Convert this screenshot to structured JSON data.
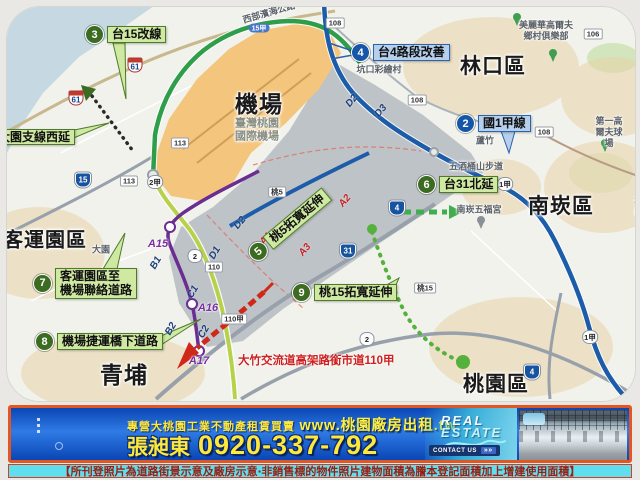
{
  "colors": {
    "green_label_bg": "#cfe8a2",
    "green_circle": "#3c6b22",
    "blue_label_bg": "#b5cfec",
    "blue_circle": "#1556a8",
    "expressway_green": "#2e9e4a",
    "highway_blue": "#1c5ca8",
    "mrt_purple": "#6a2d91",
    "banner_blue": "#1050c8",
    "banner_border": "#e35622",
    "banner_yellow": "#ffe83a",
    "disclaimer_bg": "#5fdeee",
    "disclaimer_text": "#9b1c10",
    "airport_orange": "#f4c57c",
    "note_red": "#cf1f1f"
  },
  "map": {
    "region_labels": [
      {
        "id": "airport",
        "text": "機場",
        "x": 258,
        "y": 103,
        "size": 23
      },
      {
        "id": "airport-subtitle",
        "text": "臺灣桃園\n國際機場",
        "x": 256,
        "y": 129,
        "size": 11,
        "muted": true
      },
      {
        "id": "linkou-district",
        "text": "林口區",
        "x": 492,
        "y": 66,
        "size": 21
      },
      {
        "id": "nankan-district",
        "text": "南崁區",
        "x": 560,
        "y": 206,
        "size": 21
      },
      {
        "id": "taoyuan-district",
        "text": "桃園區",
        "x": 495,
        "y": 384,
        "size": 21
      },
      {
        "id": "qingpu",
        "text": "青埔",
        "x": 123,
        "y": 374,
        "size": 23
      },
      {
        "id": "bus-terminal-park",
        "text": "客運園區",
        "x": 44,
        "y": 240,
        "size": 20
      }
    ],
    "place_labels": [
      {
        "id": "west-coast-highway",
        "text": "西部濱海公路",
        "x": 268,
        "y": 12,
        "rot": -16
      },
      {
        "id": "kengkou-painted-village",
        "text": "坑口彩繪村",
        "x": 378,
        "y": 69
      },
      {
        "id": "miramar-golf-club",
        "text": "美麗華高爾夫\n鄉村俱樂部",
        "x": 545,
        "y": 30
      },
      {
        "id": "first-golf-course",
        "text": "第一高爾夫球場",
        "x": 608,
        "y": 131
      },
      {
        "id": "wujiutong-trail",
        "text": "五酒桶山步道",
        "x": 475,
        "y": 166
      },
      {
        "id": "nankan-wufu-temple",
        "text": "南崁五福宮",
        "x": 478,
        "y": 209
      },
      {
        "id": "luzhu",
        "text": "蘆竹",
        "x": 484,
        "y": 140
      },
      {
        "id": "dayuan",
        "text": "大園",
        "x": 100,
        "y": 249
      },
      {
        "id": "taoyuan-edge",
        "text": "桃園",
        "x": 638,
        "y": 206
      }
    ],
    "project_labels": [
      {
        "id": "p3-tai15-reroute",
        "num": "3",
        "text": "台15改線",
        "color": "green",
        "x": 84,
        "y": 24
      },
      {
        "id": "p4-tai4-improvement",
        "num": "4",
        "text": "台4路段改善",
        "color": "blue",
        "x": 350,
        "y": 42
      },
      {
        "id": "p2-national1a",
        "num": "2",
        "text": "國1甲線",
        "color": "blue",
        "x": 455,
        "y": 113
      },
      {
        "id": "p6-tai31-north-ext",
        "num": "6",
        "text": "台31北延",
        "color": "green",
        "x": 416,
        "y": 174
      },
      {
        "id": "p5-tao5-widening",
        "num": "5",
        "text": "桃5拓寬延伸",
        "color": "green",
        "x": 250,
        "y": 247,
        "rot": -40
      },
      {
        "id": "p7-terminal-airport-link",
        "num": "7",
        "text": "客運園區至\n機場聯絡道路",
        "color": "green",
        "x": 32,
        "y": 267
      },
      {
        "id": "p8-mrt-underbridge-road",
        "num": "8",
        "text": "機場捷運橋下道路",
        "color": "green",
        "x": 34,
        "y": 331
      },
      {
        "id": "p9-tao15-widening",
        "num": "9",
        "text": "桃15拓寬延伸",
        "color": "green",
        "x": 291,
        "y": 282
      },
      {
        "id": "p1-dayuan-branch-west-ext",
        "num": "",
        "text": "大園支線西延",
        "color": "green",
        "x": -8,
        "y": 128
      }
    ],
    "red_note": {
      "id": "dazhu-interchange-note",
      "text": "大竹交流道高架路銜市道110甲",
      "x": 237,
      "y": 351
    },
    "shields": [
      {
        "kind": "expwy",
        "text": "61",
        "x": 75,
        "y": 97
      },
      {
        "kind": "expwy",
        "text": "61",
        "x": 134,
        "y": 64
      },
      {
        "kind": "pill",
        "text": "15甲",
        "x": 258,
        "y": 27
      },
      {
        "kind": "prov",
        "text": "15",
        "x": 82,
        "y": 179
      },
      {
        "kind": "prov",
        "text": "31",
        "x": 347,
        "y": 250
      },
      {
        "kind": "prov",
        "text": "4",
        "x": 396,
        "y": 207
      },
      {
        "kind": "prov",
        "text": "4",
        "x": 531,
        "y": 371
      },
      {
        "kind": "flower",
        "text": "2甲",
        "x": 154,
        "y": 181
      },
      {
        "kind": "flower",
        "text": "1甲",
        "x": 504,
        "y": 183
      },
      {
        "kind": "flower",
        "text": "1甲",
        "x": 589,
        "y": 336
      },
      {
        "kind": "flower",
        "text": "2",
        "x": 194,
        "y": 255
      },
      {
        "kind": "flower",
        "text": "2",
        "x": 366,
        "y": 338
      },
      {
        "kind": "rect",
        "text": "113",
        "x": 128,
        "y": 180
      },
      {
        "kind": "rect",
        "text": "113",
        "x": 179,
        "y": 142
      },
      {
        "kind": "rect",
        "text": "110",
        "x": 213,
        "y": 266
      },
      {
        "kind": "rect",
        "text": "110甲",
        "x": 233,
        "y": 318
      },
      {
        "kind": "rect",
        "text": "桃5",
        "x": 276,
        "y": 191
      },
      {
        "kind": "rect",
        "text": "桃15",
        "x": 424,
        "y": 287
      },
      {
        "kind": "rect",
        "text": "108",
        "x": 334,
        "y": 22
      },
      {
        "kind": "rect",
        "text": "108",
        "x": 416,
        "y": 99
      },
      {
        "kind": "rect",
        "text": "108",
        "x": 543,
        "y": 131
      },
      {
        "kind": "rect",
        "text": "106",
        "x": 592,
        "y": 33
      }
    ],
    "stations": [
      {
        "id": "station-a15",
        "text": "A15",
        "x": 157,
        "y": 243
      },
      {
        "id": "station-a16",
        "text": "A16",
        "x": 207,
        "y": 307
      },
      {
        "id": "station-a17",
        "text": "A17",
        "x": 198,
        "y": 360
      }
    ],
    "zone_labels": [
      {
        "text": "A1",
        "x": 265,
        "y": 238,
        "rot": -50,
        "color": "red"
      },
      {
        "text": "A2",
        "x": 344,
        "y": 200,
        "rot": -50,
        "color": "red"
      },
      {
        "text": "A3",
        "x": 304,
        "y": 249,
        "rot": -50,
        "color": "red"
      },
      {
        "text": "B1",
        "x": 155,
        "y": 262,
        "rot": -60,
        "color": "navy"
      },
      {
        "text": "B2",
        "x": 170,
        "y": 328,
        "rot": -60,
        "color": "navy"
      },
      {
        "text": "C1",
        "x": 192,
        "y": 291,
        "rot": -60,
        "color": "navy"
      },
      {
        "text": "C2",
        "x": 203,
        "y": 331,
        "rot": -60,
        "color": "navy"
      },
      {
        "text": "D1",
        "x": 214,
        "y": 252,
        "rot": -60,
        "color": "navy"
      },
      {
        "text": "D2",
        "x": 239,
        "y": 222,
        "rot": -50,
        "color": "navy"
      },
      {
        "text": "D2",
        "x": 351,
        "y": 100,
        "rot": -50,
        "color": "navy"
      },
      {
        "text": "D3",
        "x": 380,
        "y": 110,
        "rot": -50,
        "color": "navy"
      }
    ]
  },
  "banner": {
    "tagline": "專營大桃園工業不動產租賃買賣",
    "url": "www.桃園廠房出租.tw",
    "agent_name": "張昶東",
    "phone": "0920-337-792",
    "real_estate_word1": "REAL",
    "real_estate_word2": "ESTATE",
    "contact_label": "CONTACT US",
    "contact_arrows": "»»"
  },
  "disclaimer": {
    "text": "【所刊登照片為道路街景示意及廠房示意‧非銷售標的物件照片建物面積為謄本登記面積加上增建使用面積】"
  }
}
